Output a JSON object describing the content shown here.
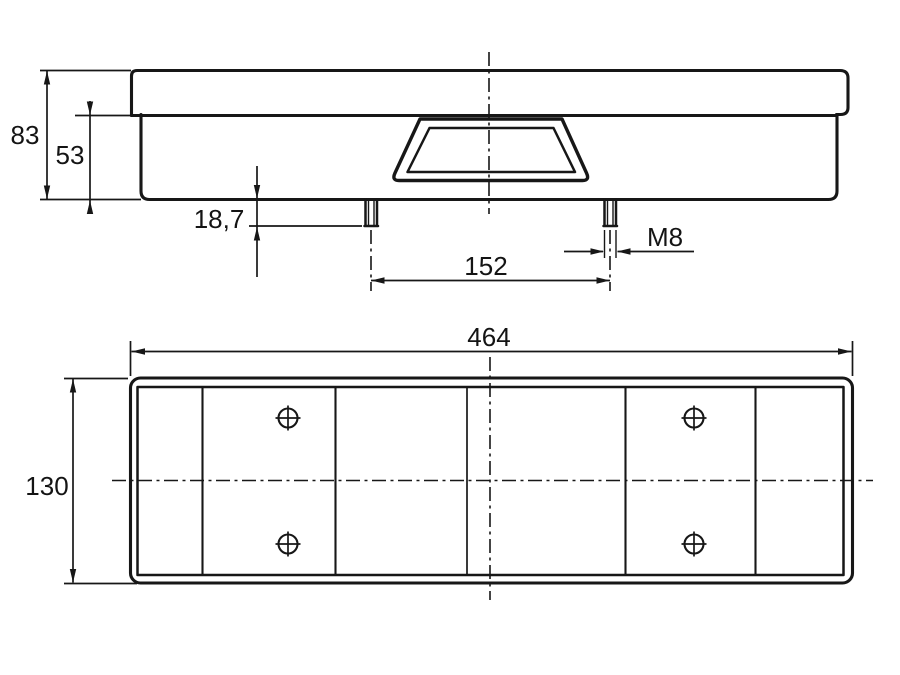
{
  "page": {
    "background": "#ffffff",
    "ink": "#171717",
    "description": "Technical dimension drawing of a rear combination lamp: side profile view with two M8 mounting studs, and rear lens face view with six lens segments and four screw marks"
  },
  "side_view": {
    "name": "side-profile-view",
    "dims": {
      "total_height": "83",
      "housing_height": "53",
      "stud_length": "18,7",
      "stud_spacing": "152",
      "thread": "M8"
    }
  },
  "rear_view": {
    "name": "rear-face-view",
    "dims": {
      "width": "464",
      "height": "130"
    }
  }
}
